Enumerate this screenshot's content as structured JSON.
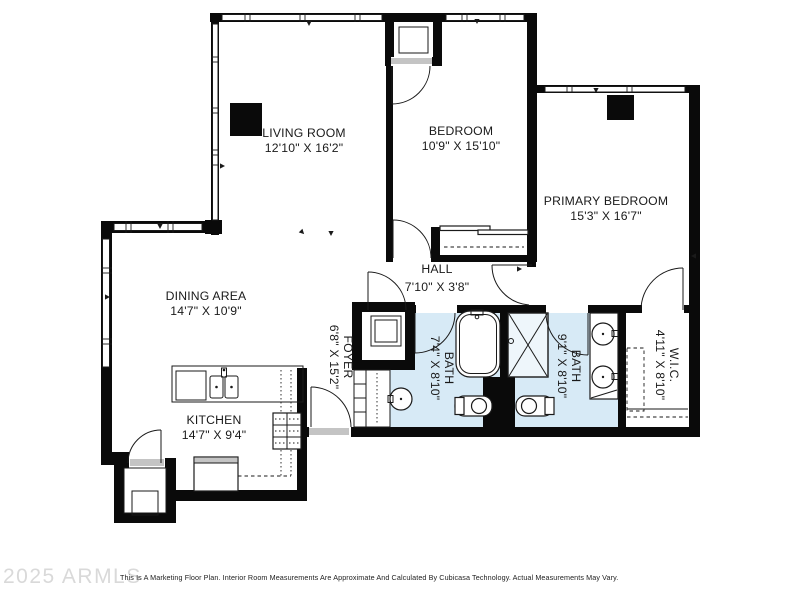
{
  "colors": {
    "wall": "#0a0a0a",
    "line": "#1a1a1a",
    "bath_fill": "#d7eaf6",
    "shower_fill": "#eef6fb",
    "sill": "#c4c4c4",
    "label": "#1a1a1a",
    "watermark": "#d9d9d9",
    "background": "#ffffff"
  },
  "rooms": {
    "living": {
      "name": "LIVING ROOM",
      "dims": "12'10\" X 16'2\""
    },
    "bedroom": {
      "name": "BEDROOM",
      "dims": "10'9\" X 15'10\""
    },
    "primary": {
      "name": "PRIMARY BEDROOM",
      "dims": "15'3\" X 16'7\""
    },
    "dining": {
      "name": "DINING AREA",
      "dims": "14'7\" X 10'9\""
    },
    "kitchen": {
      "name": "KITCHEN",
      "dims": "14'7\" X 9'4\""
    },
    "hall": {
      "name": "HALL",
      "dims": "7'10\" X 3'8\""
    },
    "foyer": {
      "name": "FOYER",
      "dims": "6'8\" X 15'2\""
    },
    "bath1": {
      "name": "BATH",
      "dims": "7'4\" X 8'10\""
    },
    "bath2": {
      "name": "BATH",
      "dims": "9'1\" X 8'10\""
    },
    "wic": {
      "name": "W.I.C.",
      "dims": "4'11\" X 8'10\""
    }
  },
  "footer": {
    "watermark": "2025 ARMLS",
    "disclaimer": "This Is A Marketing Floor Plan. Interior Room Measurements Are Approximate And Calculated By Cubicasa Technology. Actual Measurements May Vary."
  }
}
